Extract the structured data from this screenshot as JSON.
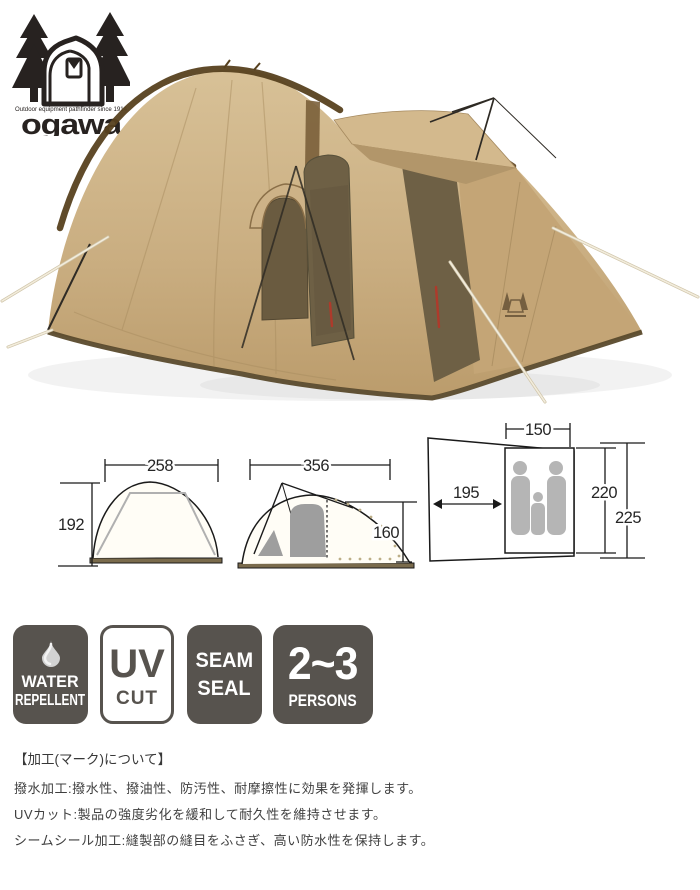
{
  "brand": {
    "logo_icon": "tent-and-trees-icon",
    "tagline": "Outdoor equipment pathfinder since 1914",
    "name": "ogawa"
  },
  "photo": {
    "subject": "tan dome tent with brown mesh door, awning and guy ropes",
    "emblem_icon": "ogawa-emblem-icon"
  },
  "dimensions": {
    "front_view": {
      "width": "258",
      "height": "192"
    },
    "side_view": {
      "width": "356",
      "height": "160"
    },
    "floor_plan": {
      "inner_width": "150",
      "vestibule_depth": "195",
      "inner_depth": "220",
      "total_depth": "225"
    }
  },
  "badges": [
    {
      "id": "water-repellent",
      "icon": "water-drop-icon",
      "line1": "WATER",
      "line2": "REPELLENT"
    },
    {
      "id": "uv-cut",
      "line1": "UV",
      "line2": "CUT"
    },
    {
      "id": "seam-seal",
      "line1": "SEAM",
      "line2": "SEAL"
    },
    {
      "id": "persons-2-3",
      "line1": "2~3",
      "line2": "PERSONS"
    }
  ],
  "notes": {
    "heading": "【加工(マーク)について】",
    "lines": [
      "撥水加工:撥水性、撥油性、防汚性、耐摩擦性に効果を発揮します。",
      "UVカット:製品の強度劣化を緩和して耐久性を維持させます。",
      "シームシール加工:縫製部の縫目をふさぎ、高い防水性を保持します。"
    ]
  },
  "colors": {
    "tent_fabric": "#c9ad80",
    "tent_trim": "#57411f",
    "tent_mesh": "#6e6045",
    "badge_dark": "#57534e",
    "diagram_gray": "#9e9e9e",
    "zipper_red": "#ae3a2b"
  }
}
